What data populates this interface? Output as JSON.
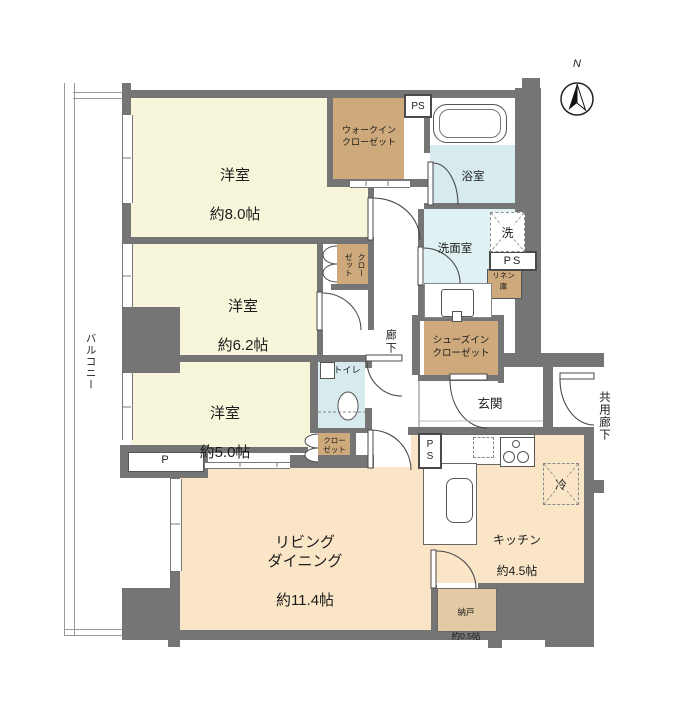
{
  "compass": {
    "north_label": "N"
  },
  "outdoor": {
    "balcony": "バルコニー",
    "common_corridor": "共用廊下",
    "porch_label": "P"
  },
  "rooms": {
    "bedroom_8": {
      "name": "洋室",
      "size": "約8.0帖"
    },
    "bedroom_6": {
      "name": "洋室",
      "size": "約6.2帖"
    },
    "bedroom_5": {
      "name": "洋室",
      "size": "約5.0帖"
    },
    "living_dining": {
      "name": "リビング\nダイニング",
      "size": "約11.4帖"
    },
    "kitchen": {
      "name": "キッチン",
      "size": "約4.5帖"
    },
    "storage": {
      "name": "納戸",
      "size": "約0.5帖"
    },
    "bathroom": "浴室",
    "washroom": "洗面室",
    "toilet": "トイレ",
    "hallway": "廊下",
    "entrance": "玄関"
  },
  "closets": {
    "walk_in_closet": "ウォークイン\nクローゼット",
    "shoes_in_closet": "シューズイン\nクローゼット",
    "closet_bedroom6": "クロー\nゼット",
    "closet_bedroom5": "クロー\nゼット",
    "linen": "リネン\n庫"
  },
  "fixtures": {
    "pipe_space_top": "PS",
    "pipe_space_mid": "PS",
    "pipe_space_kitchen": "PS",
    "washer": "洗",
    "refrigerator": "冷"
  },
  "colors": {
    "wall": "#757575",
    "bedroom_fill": "#F7F6DB",
    "living_fill": "#FAE5C7",
    "closet_fill": "#CDA97B",
    "storage_fill": "#E2CBA4",
    "wet_area_fill": "#D7EBEE",
    "washroom_fill": "#DFF1F3"
  }
}
